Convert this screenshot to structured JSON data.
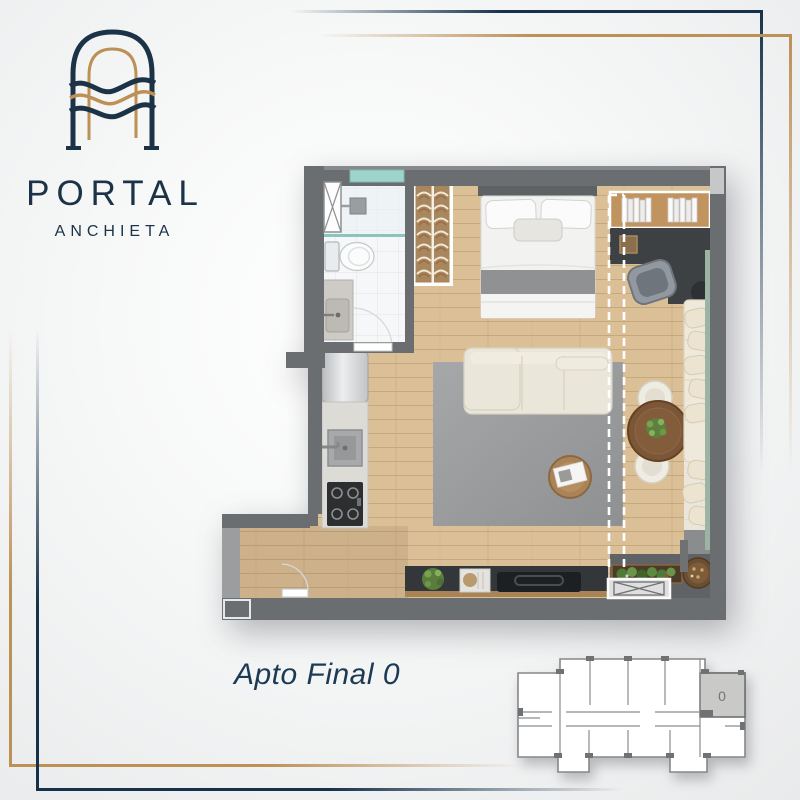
{
  "brand": {
    "name": "PORTAL",
    "subname": "ANCHIETA",
    "logo_icon": "arch-with-waves",
    "colors": {
      "navy": "#1c3347",
      "gold": "#bd9056"
    }
  },
  "floor_plan": {
    "caption": "Apto Final 0",
    "view": "top-down furnished render",
    "rooms": [
      "bathroom",
      "closet",
      "bedroom",
      "desk-area",
      "kitchen",
      "living-room",
      "dining-area",
      "balcony",
      "entry-corridor"
    ],
    "furniture": [
      "shower",
      "toilet",
      "vanity-sink",
      "wardrobe-hangers",
      "double-bed",
      "bookshelf",
      "desk",
      "desk-chair",
      "sofa",
      "rug",
      "wood-pouf-side-table",
      "tv-console",
      "plant",
      "decor-tray",
      "round-dining-table",
      "dining-chairs",
      "chaise-with-pillows",
      "fridge",
      "kitchen-sink",
      "cooktop",
      "planter-box",
      "woven-basket",
      "entry-door",
      "sliding-door-dashed-line",
      "condenser-unit"
    ],
    "colors": {
      "wall": "#6b6e70",
      "wood_floor": "#d8bc94",
      "tile": "#f5f7f8",
      "rug": "#98999b",
      "sofa": "#eae6d9",
      "glass": "#7fbfb7"
    }
  },
  "key_plan": {
    "description": "building floor key plan",
    "highlighted_unit_label": "0"
  }
}
